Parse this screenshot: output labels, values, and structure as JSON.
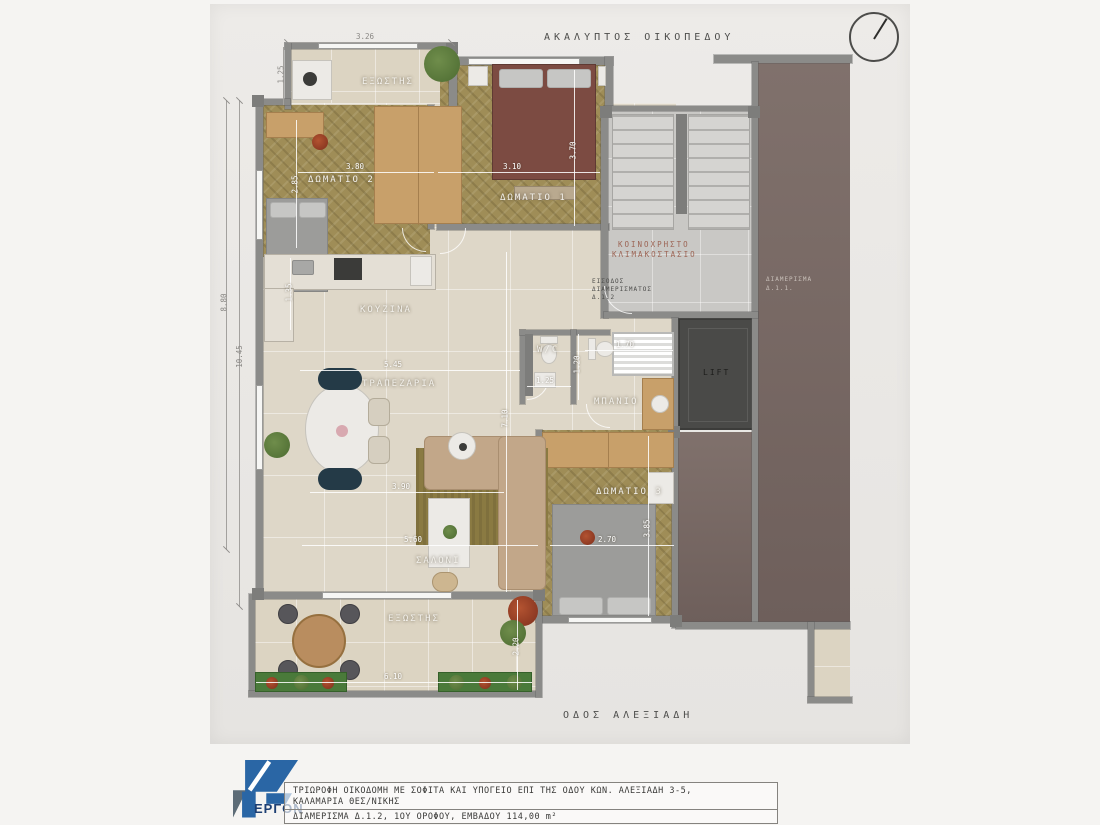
{
  "labels": {
    "site_top": "ΑΚΑΛΥΠΤΟΣ ΟΙΚΟΠΕΔΟΥ",
    "street": "ΟΔΟΣ ΑΛΕΞΙΑΔΗ",
    "balcony_top": "ΕΞΩΣΤΗΣ",
    "balcony_bottom": "ΕΞΩΣΤΗΣ",
    "bedroom2": "ΔΩΜΑΤΙΟ 2",
    "bedroom1": "ΔΩΜΑΤΙΟ 1",
    "bedroom3": "ΔΩΜΑΤΙΟ 3",
    "kitchen": "ΚΟΥΖΙΝΑ",
    "dining": "ΤΡΑΠΕΖΑΡΙΑ",
    "living": "ΣΑΛΟΝΙ",
    "wc": "W/C",
    "bathroom": "ΜΠΑΝΙΟ",
    "lift": "LIFT",
    "stairs_line1": "ΚΟΙΝΟΧΡΗΣΤΟ",
    "stairs_line2": "ΚΛΙΜΑΚΟΣΤΑΣΙΟ",
    "entrance_line1": "ΕΙΣΟΔΟΣ",
    "entrance_line2": "ΔΙΑΜΕΡΙΣΜΑΤΟΣ",
    "entrance_line3": "Δ.1.2",
    "neighbor_line1": "ΔΙΑΜΕΡΙΣΜΑ",
    "neighbor_line2": "Δ.1.1."
  },
  "dimensions": {
    "top_width": "3.26",
    "left_small": "1.25",
    "left_inner": "8.80",
    "left_outer": "10.45",
    "bedroom2_w": "3.80",
    "bedroom2_h": "2.85",
    "bedroom1_w": "3.10",
    "bedroom1_h": "3.70",
    "kitchen_h": "1.35",
    "dining_w": "5.45",
    "living_h": "7.10",
    "wc_w": "1.25",
    "bath_w": "1.70",
    "bath_h": "1.20",
    "bedroom3_w": "2.70",
    "bedroom3_h": "3.85",
    "living_w1": "3.90",
    "living_w2": "5.60",
    "terrace_h": "2.20",
    "terrace_w": "6.10"
  },
  "titleblock": {
    "logo_text": "ΕΡΓΟΝ",
    "line1": "ΤΡΙΩΡΟΦΗ ΟΙΚΟΔΟΜΗ ΜΕ ΣΟΦΙΤΑ ΚΑΙ ΥΠΟΓΕΙΟ ΕΠΙ ΤΗΣ ΟΔΟΥ ΚΩΝ. ΑΛΕΞΙΑΔΗ 3-5,",
    "line2": "ΚΑΛΑΜΑΡΙΑ ΘΕΣ/ΝΙΚΗΣ",
    "line3": "ΔΙΑΜΕΡΙΣΜΑ Δ.1.2, 1ΟΥ ΟΡΟΦΟΥ, ΕΜΒΑΔΟΥ 114,00 m²"
  },
  "colors": {
    "logo_blue": "#2a66a5",
    "wall_gray": "#8b8b89",
    "wood_floor": "#9f8d57",
    "tile_beige": "#ded7c8",
    "stair_gray": "#c9c8c5",
    "neighbor_brown": "#776863",
    "lift_dark": "#4a4a48",
    "stairs_label_red": "#9c6454"
  }
}
